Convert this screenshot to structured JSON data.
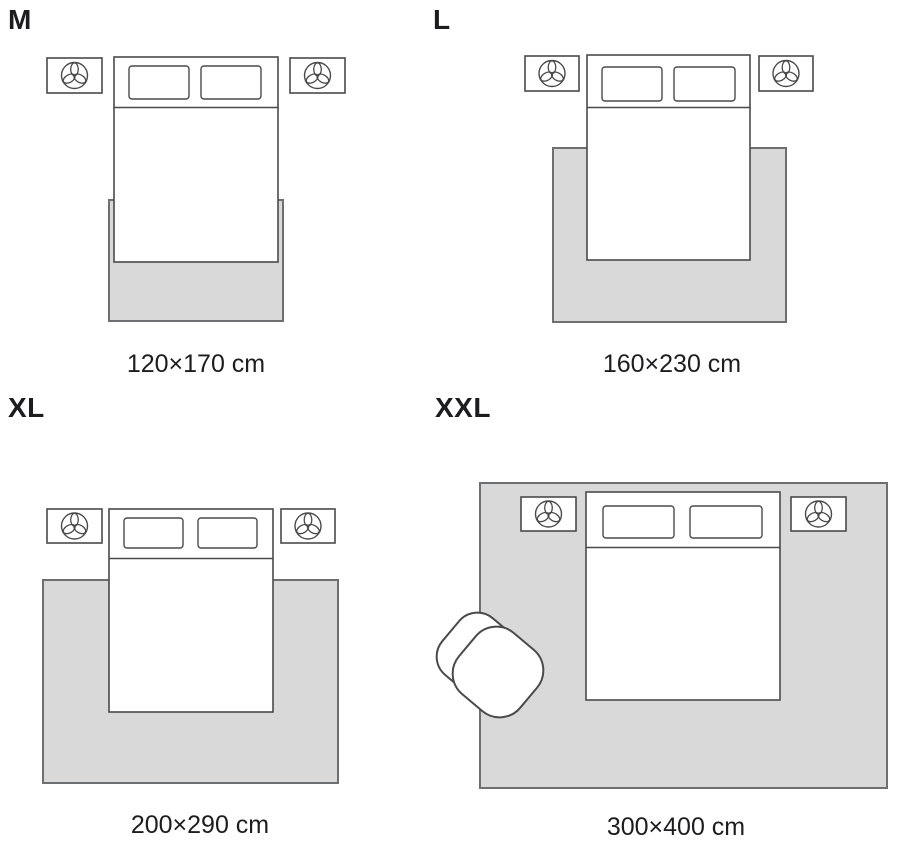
{
  "sizes": [
    {
      "label": "M",
      "dimensions": "120×170 cm"
    },
    {
      "label": "L",
      "dimensions": "160×230 cm"
    },
    {
      "label": "XL",
      "dimensions": "200×290 cm"
    },
    {
      "label": "XXL",
      "dimensions": "300×400 cm"
    }
  ],
  "icons": {
    "nightstand": "plant-icon",
    "seat": "armchair-icon"
  },
  "colors": {
    "background": "#ffffff",
    "rug_fill": "#d9d9d9",
    "rug_border": "#6d6f70",
    "furniture_fill": "#ffffff",
    "furniture_border": "#4a4a4b",
    "text": "#1d1d1f"
  }
}
